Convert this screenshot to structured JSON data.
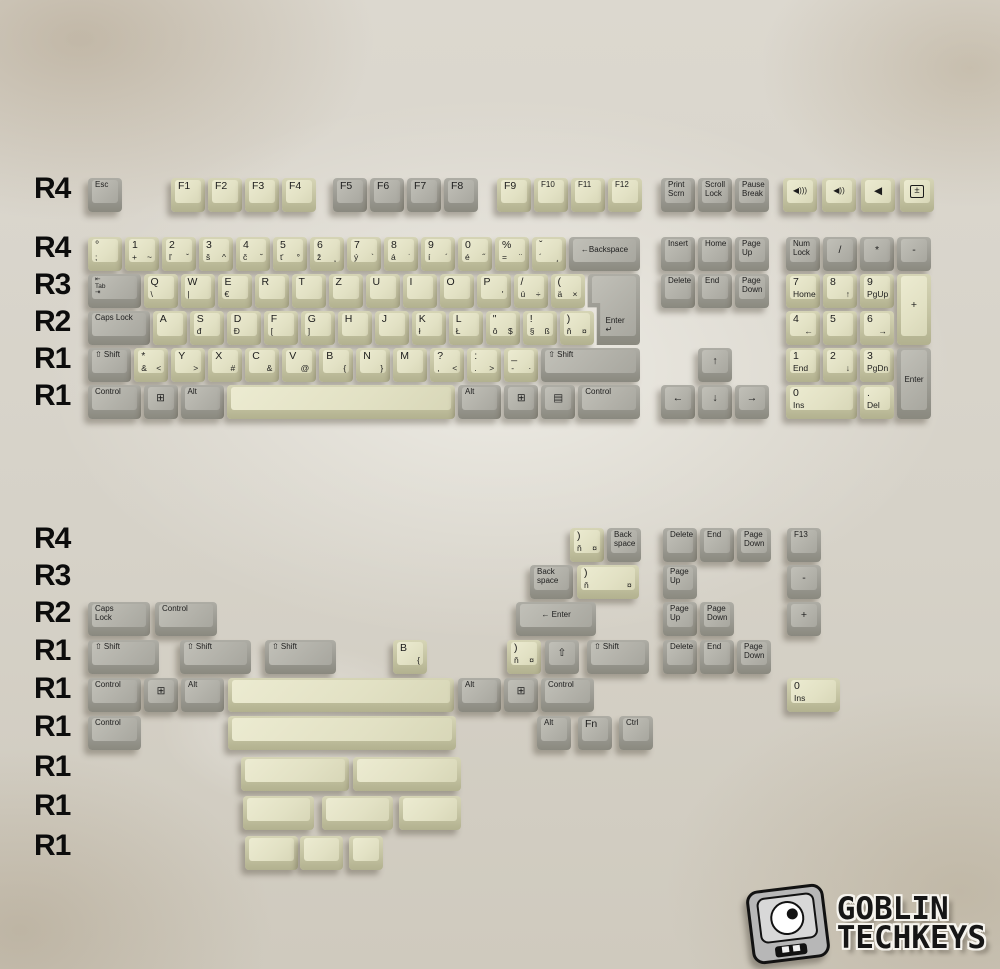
{
  "unit": 37,
  "canvas": {
    "w": 1000,
    "h": 969
  },
  "colors": {
    "background": "#d8d4ca",
    "gray_key_top": "#b2b1a9",
    "gray_key_side": "#9b9a92",
    "beige_key_top": "#e2e1c4",
    "beige_key_side": "#c4c3a2",
    "legend": "#1d1d1d",
    "row_label": "#0c0c0c"
  },
  "logo": {
    "line1": "GOBLIN",
    "line2": "TECHKEYS"
  },
  "row_labels": [
    {
      "t": "R4",
      "y": 180
    },
    {
      "t": "R4",
      "y": 239
    },
    {
      "t": "R3",
      "y": 276
    },
    {
      "t": "R2",
      "y": 313
    },
    {
      "t": "R1",
      "y": 350
    },
    {
      "t": "R1",
      "y": 387
    },
    {
      "t": "R4",
      "y": 530
    },
    {
      "t": "R3",
      "y": 567
    },
    {
      "t": "R2",
      "y": 604
    },
    {
      "t": "R1",
      "y": 642
    },
    {
      "t": "R1",
      "y": 680
    },
    {
      "t": "R1",
      "y": 718
    },
    {
      "t": "R1",
      "y": 758
    },
    {
      "t": "R1",
      "y": 797
    },
    {
      "t": "R1",
      "y": 837
    }
  ],
  "keys": [
    {
      "x": 88,
      "y": 178,
      "w": 1,
      "c": "g",
      "t": "Esc",
      "n": "esc"
    },
    {
      "x": 171,
      "y": 178,
      "w": 1,
      "c": "b",
      "t": "F1"
    },
    {
      "x": 208,
      "y": 178,
      "w": 1,
      "c": "b",
      "t": "F2"
    },
    {
      "x": 245,
      "y": 178,
      "w": 1,
      "c": "b",
      "t": "F3"
    },
    {
      "x": 282,
      "y": 178,
      "w": 1,
      "c": "b",
      "t": "F4"
    },
    {
      "x": 333,
      "y": 178,
      "w": 1,
      "c": "g",
      "t": "F5"
    },
    {
      "x": 370,
      "y": 178,
      "w": 1,
      "c": "g",
      "t": "F6"
    },
    {
      "x": 407,
      "y": 178,
      "w": 1,
      "c": "g",
      "t": "F7"
    },
    {
      "x": 444,
      "y": 178,
      "w": 1,
      "c": "g",
      "t": "F8"
    },
    {
      "x": 497,
      "y": 178,
      "w": 1,
      "c": "b",
      "t": "F9"
    },
    {
      "x": 534,
      "y": 178,
      "w": 1,
      "c": "b",
      "t": "F10"
    },
    {
      "x": 571,
      "y": 178,
      "w": 1,
      "c": "b",
      "t": "F11"
    },
    {
      "x": 608,
      "y": 178,
      "w": 1,
      "c": "b",
      "t": "F12"
    },
    {
      "x": 661,
      "y": 178,
      "w": 1,
      "c": "g",
      "t": "Print\nScrn",
      "n": "print-screen"
    },
    {
      "x": 698,
      "y": 178,
      "w": 1,
      "c": "g",
      "t": "Scroll\nLock",
      "n": "scroll-lock"
    },
    {
      "x": 735,
      "y": 178,
      "w": 1,
      "c": "g",
      "t": "Pause\nBreak",
      "n": "pause-break"
    },
    {
      "x": 783,
      "y": 178,
      "w": 1,
      "c": "b",
      "t": "◀)))",
      "f": "c",
      "n": "volume-up"
    },
    {
      "x": 822,
      "y": 178,
      "w": 1,
      "c": "b",
      "t": "◀))",
      "f": "c",
      "n": "volume-down"
    },
    {
      "x": 861,
      "y": 178,
      "w": 1,
      "c": "b",
      "t": "◀",
      "f": "c",
      "n": "volume-mute"
    },
    {
      "x": 900,
      "y": 178,
      "w": 1,
      "c": "b",
      "t": "±",
      "f": "cx",
      "n": "calculator"
    },
    {
      "x": 88,
      "y": 237,
      "w": 1,
      "c": "b",
      "t": "°",
      "b": ";",
      "n": "semicolon"
    },
    {
      "x": 125,
      "y": 237,
      "w": 1,
      "c": "b",
      "t": "1",
      "b": "+",
      "r": "~"
    },
    {
      "x": 162,
      "y": 237,
      "w": 1,
      "c": "b",
      "t": "2",
      "b": "ľ",
      "r": "ˇ"
    },
    {
      "x": 199,
      "y": 237,
      "w": 1,
      "c": "b",
      "t": "3",
      "b": "š",
      "r": "^"
    },
    {
      "x": 236,
      "y": 237,
      "w": 1,
      "c": "b",
      "t": "4",
      "b": "č",
      "r": "˘"
    },
    {
      "x": 273,
      "y": 237,
      "w": 1,
      "c": "b",
      "t": "5",
      "b": "ť",
      "r": "°"
    },
    {
      "x": 310,
      "y": 237,
      "w": 1,
      "c": "b",
      "t": "6",
      "b": "ž",
      "r": "˛"
    },
    {
      "x": 347,
      "y": 237,
      "w": 1,
      "c": "b",
      "t": "7",
      "b": "ý",
      "r": "`"
    },
    {
      "x": 384,
      "y": 237,
      "w": 1,
      "c": "b",
      "t": "8",
      "b": "á",
      "r": "˙"
    },
    {
      "x": 421,
      "y": 237,
      "w": 1,
      "c": "b",
      "t": "9",
      "b": "í",
      "r": "´"
    },
    {
      "x": 458,
      "y": 237,
      "w": 1,
      "c": "b",
      "t": "0",
      "b": "é",
      "r": "˝"
    },
    {
      "x": 495,
      "y": 237,
      "w": 1,
      "c": "b",
      "t": "%",
      "b": "=",
      "r": "¨"
    },
    {
      "x": 532,
      "y": 237,
      "w": 1,
      "c": "b",
      "t": "ˇ",
      "b": "´",
      "r": "¸",
      "n": "caron-acute"
    },
    {
      "x": 569,
      "y": 237,
      "w": 2,
      "c": "g",
      "t": "←Backspace",
      "f": "c",
      "n": "backspace"
    },
    {
      "x": 88,
      "y": 274,
      "w": 1.5,
      "c": "g",
      "t": "⇤\nTab\n⇥",
      "n": "tab"
    },
    {
      "x": 143.5,
      "y": 274,
      "w": 1,
      "c": "b",
      "t": "Q",
      "b": "\\"
    },
    {
      "x": 180.5,
      "y": 274,
      "w": 1,
      "c": "b",
      "t": "W",
      "b": "|"
    },
    {
      "x": 217.5,
      "y": 274,
      "w": 1,
      "c": "b",
      "t": "E",
      "b": "€"
    },
    {
      "x": 254.5,
      "y": 274,
      "w": 1,
      "c": "b",
      "t": "R"
    },
    {
      "x": 291.5,
      "y": 274,
      "w": 1,
      "c": "b",
      "t": "T"
    },
    {
      "x": 328.5,
      "y": 274,
      "w": 1,
      "c": "b",
      "t": "Z"
    },
    {
      "x": 365.5,
      "y": 274,
      "w": 1,
      "c": "b",
      "t": "U"
    },
    {
      "x": 402.5,
      "y": 274,
      "w": 1,
      "c": "b",
      "t": "I"
    },
    {
      "x": 439.5,
      "y": 274,
      "w": 1,
      "c": "b",
      "t": "O"
    },
    {
      "x": 476.5,
      "y": 274,
      "w": 1,
      "c": "b",
      "t": "P",
      "r": "'"
    },
    {
      "x": 513.5,
      "y": 274,
      "w": 1,
      "c": "b",
      "t": "/",
      "b": "ú",
      "r": "÷",
      "n": "u-acute"
    },
    {
      "x": 550.5,
      "y": 274,
      "w": 1,
      "c": "b",
      "t": "(",
      "b": "ä",
      "r": "×",
      "n": "a-umlaut"
    },
    {
      "x": 587.5,
      "y": 274,
      "w": 1.5,
      "h": 2,
      "c": "g",
      "t": "Enter\n↵",
      "f": "i",
      "n": "iso-enter"
    },
    {
      "x": 88,
      "y": 311,
      "w": 1.75,
      "c": "g",
      "t": "Caps Lock",
      "n": "caps-lock"
    },
    {
      "x": 152.75,
      "y": 311,
      "w": 1,
      "c": "b",
      "t": "A"
    },
    {
      "x": 189.75,
      "y": 311,
      "w": 1,
      "c": "b",
      "t": "S",
      "b": "đ"
    },
    {
      "x": 226.75,
      "y": 311,
      "w": 1,
      "c": "b",
      "t": "D",
      "b": "Đ"
    },
    {
      "x": 263.75,
      "y": 311,
      "w": 1,
      "c": "b",
      "t": "F",
      "b": "["
    },
    {
      "x": 300.75,
      "y": 311,
      "w": 1,
      "c": "b",
      "t": "G",
      "b": "]"
    },
    {
      "x": 337.75,
      "y": 311,
      "w": 1,
      "c": "b",
      "t": "H"
    },
    {
      "x": 374.75,
      "y": 311,
      "w": 1,
      "c": "b",
      "t": "J"
    },
    {
      "x": 411.75,
      "y": 311,
      "w": 1,
      "c": "b",
      "t": "K",
      "b": "ł"
    },
    {
      "x": 448.75,
      "y": 311,
      "w": 1,
      "c": "b",
      "t": "L",
      "b": "Ł"
    },
    {
      "x": 485.75,
      "y": 311,
      "w": 1,
      "c": "b",
      "t": "\"",
      "b": "ô",
      "r": "$",
      "n": "o-circumflex"
    },
    {
      "x": 522.75,
      "y": 311,
      "w": 1,
      "c": "b",
      "t": "!",
      "b": "§",
      "r": "ß",
      "n": "section"
    },
    {
      "x": 559.75,
      "y": 311,
      "w": 1,
      "c": "b",
      "t": ")",
      "b": "ň",
      "r": "¤",
      "n": "n-caron"
    },
    {
      "x": 88,
      "y": 348,
      "w": 1.25,
      "c": "g",
      "t": "⇧ Shift",
      "n": "left-shift"
    },
    {
      "x": 134.25,
      "y": 348,
      "w": 1,
      "c": "b",
      "t": "*",
      "b": "&",
      "r": "<",
      "n": "iso-extra"
    },
    {
      "x": 171.25,
      "y": 348,
      "w": 1,
      "c": "b",
      "t": "Y",
      "r": ">"
    },
    {
      "x": 208.25,
      "y": 348,
      "w": 1,
      "c": "b",
      "t": "X",
      "r": "#"
    },
    {
      "x": 245.25,
      "y": 348,
      "w": 1,
      "c": "b",
      "t": "C",
      "r": "&"
    },
    {
      "x": 282.25,
      "y": 348,
      "w": 1,
      "c": "b",
      "t": "V",
      "r": "@"
    },
    {
      "x": 319.25,
      "y": 348,
      "w": 1,
      "c": "b",
      "t": "B",
      "r": "{"
    },
    {
      "x": 356.25,
      "y": 348,
      "w": 1,
      "c": "b",
      "t": "N",
      "r": "}"
    },
    {
      "x": 393.25,
      "y": 348,
      "w": 1,
      "c": "b",
      "t": "M"
    },
    {
      "x": 430.25,
      "y": 348,
      "w": 1,
      "c": "b",
      "t": "?",
      "b": ",",
      "r": "<",
      "n": "comma"
    },
    {
      "x": 467.25,
      "y": 348,
      "w": 1,
      "c": "b",
      "t": ":",
      "b": ".",
      "r": ">",
      "n": "period"
    },
    {
      "x": 504.25,
      "y": 348,
      "w": 1,
      "c": "b",
      "t": "_",
      "b": "-",
      "r": "·",
      "n": "dash"
    },
    {
      "x": 541.25,
      "y": 348,
      "w": 2.75,
      "c": "g",
      "t": "⇧ Shift",
      "n": "right-shift"
    },
    {
      "x": 88,
      "y": 385,
      "w": 1.5,
      "c": "g",
      "t": "Control",
      "n": "left-control"
    },
    {
      "x": 143.5,
      "y": 385,
      "w": 1,
      "c": "g",
      "t": "⊞",
      "f": "c",
      "n": "left-win"
    },
    {
      "x": 180.5,
      "y": 385,
      "w": 1.25,
      "c": "g",
      "t": "Alt",
      "n": "left-alt"
    },
    {
      "x": 226.75,
      "y": 385,
      "w": 6.25,
      "c": "b",
      "n": "spacebar"
    },
    {
      "x": 458,
      "y": 385,
      "w": 1.25,
      "c": "g",
      "t": "Alt",
      "n": "right-alt"
    },
    {
      "x": 504.25,
      "y": 385,
      "w": 1,
      "c": "g",
      "t": "⊞",
      "f": "c",
      "n": "right-win"
    },
    {
      "x": 541.25,
      "y": 385,
      "w": 1,
      "c": "g",
      "t": "▤",
      "f": "c",
      "n": "menu"
    },
    {
      "x": 578.25,
      "y": 385,
      "w": 1.75,
      "c": "g",
      "t": "Control",
      "n": "right-control"
    },
    {
      "x": 661,
      "y": 237,
      "w": 1,
      "c": "g",
      "t": "Insert",
      "n": "insert"
    },
    {
      "x": 698,
      "y": 237,
      "w": 1,
      "c": "g",
      "t": "Home",
      "n": "home"
    },
    {
      "x": 735,
      "y": 237,
      "w": 1,
      "c": "g",
      "t": "Page\nUp",
      "n": "page-up"
    },
    {
      "x": 661,
      "y": 274,
      "w": 1,
      "c": "g",
      "t": "Delete",
      "n": "delete"
    },
    {
      "x": 698,
      "y": 274,
      "w": 1,
      "c": "g",
      "t": "End",
      "n": "end"
    },
    {
      "x": 735,
      "y": 274,
      "w": 1,
      "c": "g",
      "t": "Page\nDown",
      "n": "page-down"
    },
    {
      "x": 698,
      "y": 348,
      "w": 1,
      "c": "g",
      "t": "↑",
      "f": "c",
      "n": "arrow-up"
    },
    {
      "x": 661,
      "y": 385,
      "w": 1,
      "c": "g",
      "t": "←",
      "f": "c",
      "n": "arrow-left"
    },
    {
      "x": 698,
      "y": 385,
      "w": 1,
      "c": "g",
      "t": "↓",
      "f": "c",
      "n": "arrow-down"
    },
    {
      "x": 735,
      "y": 385,
      "w": 1,
      "c": "g",
      "t": "→",
      "f": "c",
      "n": "arrow-right"
    },
    {
      "x": 786,
      "y": 237,
      "w": 1,
      "c": "g",
      "t": "Num\nLock",
      "n": "num-lock"
    },
    {
      "x": 823,
      "y": 237,
      "w": 1,
      "c": "g",
      "t": "/",
      "f": "c",
      "n": "numpad-divide"
    },
    {
      "x": 860,
      "y": 237,
      "w": 1,
      "c": "g",
      "t": "*",
      "f": "c",
      "n": "numpad-multiply"
    },
    {
      "x": 897,
      "y": 237,
      "w": 1,
      "c": "g",
      "t": "-",
      "f": "c",
      "n": "numpad-minus"
    },
    {
      "x": 786,
      "y": 274,
      "w": 1,
      "c": "b",
      "t": "7",
      "b": "Home",
      "n": "numpad-7"
    },
    {
      "x": 823,
      "y": 274,
      "w": 1,
      "c": "b",
      "t": "8",
      "r": "↑",
      "n": "numpad-8"
    },
    {
      "x": 860,
      "y": 274,
      "w": 1,
      "c": "b",
      "t": "9",
      "b": "PgUp",
      "n": "numpad-9"
    },
    {
      "x": 897,
      "y": 274,
      "w": 1,
      "h": 2,
      "c": "b",
      "t": "+",
      "f": "c",
      "n": "numpad-plus"
    },
    {
      "x": 786,
      "y": 311,
      "w": 1,
      "c": "b",
      "t": "4",
      "r": "←",
      "n": "numpad-4"
    },
    {
      "x": 823,
      "y": 311,
      "w": 1,
      "c": "b",
      "t": "5",
      "n": "numpad-5"
    },
    {
      "x": 860,
      "y": 311,
      "w": 1,
      "c": "b",
      "t": "6",
      "r": "→",
      "n": "numpad-6"
    },
    {
      "x": 786,
      "y": 348,
      "w": 1,
      "c": "b",
      "t": "1",
      "b": "End",
      "n": "numpad-1"
    },
    {
      "x": 823,
      "y": 348,
      "w": 1,
      "c": "b",
      "t": "2",
      "r": "↓",
      "n": "numpad-2"
    },
    {
      "x": 860,
      "y": 348,
      "w": 1,
      "c": "b",
      "t": "3",
      "b": "PgDn",
      "n": "numpad-3"
    },
    {
      "x": 897,
      "y": 348,
      "w": 1,
      "h": 2,
      "c": "g",
      "t": "Enter",
      "f": "c",
      "n": "numpad-enter"
    },
    {
      "x": 786,
      "y": 385,
      "w": 2,
      "c": "b",
      "t": "0",
      "b": "Ins",
      "n": "numpad-0"
    },
    {
      "x": 860,
      "y": 385,
      "w": 1,
      "c": "b",
      "t": ".",
      "b": "Del",
      "n": "numpad-dot"
    },
    {
      "x": 570,
      "y": 528,
      "w": 1,
      "c": "b",
      "t": ")",
      "b": "ň",
      "r": "¤",
      "n": "n-caron-r4"
    },
    {
      "x": 607,
      "y": 528,
      "w": 1,
      "c": "g",
      "t": "Back\nspace",
      "n": "backspace-r4"
    },
    {
      "x": 663,
      "y": 528,
      "w": 1,
      "c": "g",
      "t": "Delete"
    },
    {
      "x": 700,
      "y": 528,
      "w": 1,
      "c": "g",
      "t": "End"
    },
    {
      "x": 737,
      "y": 528,
      "w": 1,
      "c": "g",
      "t": "Page\nDown"
    },
    {
      "x": 787,
      "y": 528,
      "w": 1,
      "c": "g",
      "t": "F13"
    },
    {
      "x": 530,
      "y": 565,
      "w": 1.25,
      "c": "g",
      "t": "Back\nspace",
      "n": "backspace-r3"
    },
    {
      "x": 577,
      "y": 565,
      "w": 1.75,
      "c": "b",
      "t": ")",
      "b": "ň",
      "r": "¤",
      "n": "n-caron-r3"
    },
    {
      "x": 663,
      "y": 565,
      "w": 1,
      "c": "g",
      "t": "Page\nUp"
    },
    {
      "x": 787,
      "y": 565,
      "w": 1,
      "c": "g",
      "t": "-",
      "f": "c",
      "n": "minus-r3"
    },
    {
      "x": 88,
      "y": 602,
      "w": 1.75,
      "c": "g",
      "t": "Caps\nLock",
      "n": "caps-lock-r2"
    },
    {
      "x": 155,
      "y": 602,
      "w": 1.75,
      "c": "g",
      "t": "Control",
      "n": "control-r2"
    },
    {
      "x": 516,
      "y": 602,
      "w": 2.25,
      "c": "g",
      "t": "← Enter",
      "f": "c",
      "n": "enter-r2"
    },
    {
      "x": 663,
      "y": 602,
      "w": 1,
      "c": "g",
      "t": "Page\nUp"
    },
    {
      "x": 700,
      "y": 602,
      "w": 1,
      "c": "g",
      "t": "Page\nDown"
    },
    {
      "x": 787,
      "y": 602,
      "w": 1,
      "c": "g",
      "t": "+",
      "f": "c",
      "n": "plus-r2"
    },
    {
      "x": 88,
      "y": 640,
      "w": 2,
      "c": "g",
      "t": "⇧ Shift",
      "n": "shift-2u"
    },
    {
      "x": 180,
      "y": 640,
      "w": 2,
      "c": "g",
      "t": "⇧ Shift",
      "n": "shift-2u-b"
    },
    {
      "x": 265,
      "y": 640,
      "w": 2,
      "c": "g",
      "t": "⇧ Shift",
      "n": "shift-2u-c"
    },
    {
      "x": 393,
      "y": 640,
      "w": 1,
      "c": "b",
      "t": "B",
      "r": "{",
      "n": "b-key-r1"
    },
    {
      "x": 507,
      "y": 640,
      "w": 1,
      "c": "b",
      "t": ")",
      "b": "ň",
      "r": "¤",
      "n": "n-caron-r1"
    },
    {
      "x": 545,
      "y": 640,
      "w": 1,
      "c": "g",
      "t": "⇧",
      "f": "c",
      "n": "shift-icon-key"
    },
    {
      "x": 587,
      "y": 640,
      "w": 1.75,
      "c": "g",
      "t": "⇧ Shift",
      "n": "shift-175"
    },
    {
      "x": 663,
      "y": 640,
      "w": 1,
      "c": "g",
      "t": "Delete"
    },
    {
      "x": 700,
      "y": 640,
      "w": 1,
      "c": "g",
      "t": "End"
    },
    {
      "x": 737,
      "y": 640,
      "w": 1,
      "c": "g",
      "t": "Page\nDown"
    },
    {
      "x": 88,
      "y": 678,
      "w": 1.5,
      "c": "g",
      "t": "Control"
    },
    {
      "x": 144,
      "y": 678,
      "w": 1,
      "c": "g",
      "t": "⊞",
      "f": "c",
      "n": "win-b1"
    },
    {
      "x": 181,
      "y": 678,
      "w": 1.25,
      "c": "g",
      "t": "Alt"
    },
    {
      "x": 228,
      "y": 678,
      "w": 6.2,
      "c": "b",
      "n": "spacebar-b1"
    },
    {
      "x": 458,
      "y": 678,
      "w": 1.25,
      "c": "g",
      "t": "Alt"
    },
    {
      "x": 504,
      "y": 678,
      "w": 1,
      "c": "g",
      "t": "⊞",
      "f": "c",
      "n": "win-b2"
    },
    {
      "x": 541,
      "y": 678,
      "w": 1.5,
      "c": "g",
      "t": "Control"
    },
    {
      "x": 787,
      "y": 678,
      "w": 1.5,
      "c": "b",
      "t": "0",
      "b": "Ins",
      "n": "numpad-0-15u"
    },
    {
      "x": 88,
      "y": 716,
      "w": 1.5,
      "c": "g",
      "t": "Control"
    },
    {
      "x": 228,
      "y": 716,
      "w": 6.25,
      "c": "b",
      "n": "spacebar-b2"
    },
    {
      "x": 537,
      "y": 716,
      "w": 1,
      "c": "g",
      "t": "Alt"
    },
    {
      "x": 578,
      "y": 716,
      "w": 1,
      "c": "g",
      "t": "Fn",
      "n": "fn"
    },
    {
      "x": 619,
      "y": 716,
      "w": 1,
      "c": "g",
      "t": "Ctrl",
      "n": "ctrl-short"
    },
    {
      "x": 241,
      "y": 757,
      "w": 3,
      "c": "b",
      "n": "blank-3u-a"
    },
    {
      "x": 353,
      "y": 757,
      "w": 3,
      "c": "b",
      "n": "blank-3u-b"
    },
    {
      "x": 243,
      "y": 796,
      "w": 2,
      "c": "b",
      "n": "blank-2u-a"
    },
    {
      "x": 322,
      "y": 796,
      "w": 2,
      "c": "b",
      "n": "blank-2u-b"
    },
    {
      "x": 399,
      "y": 796,
      "w": 1.75,
      "c": "b",
      "n": "blank-175u"
    },
    {
      "x": 245,
      "y": 836,
      "w": 1.5,
      "c": "b",
      "n": "blank-15u"
    },
    {
      "x": 300,
      "y": 836,
      "w": 1.25,
      "c": "b",
      "n": "blank-125u"
    },
    {
      "x": 349,
      "y": 836,
      "w": 1,
      "c": "b",
      "n": "blank-1u"
    }
  ]
}
